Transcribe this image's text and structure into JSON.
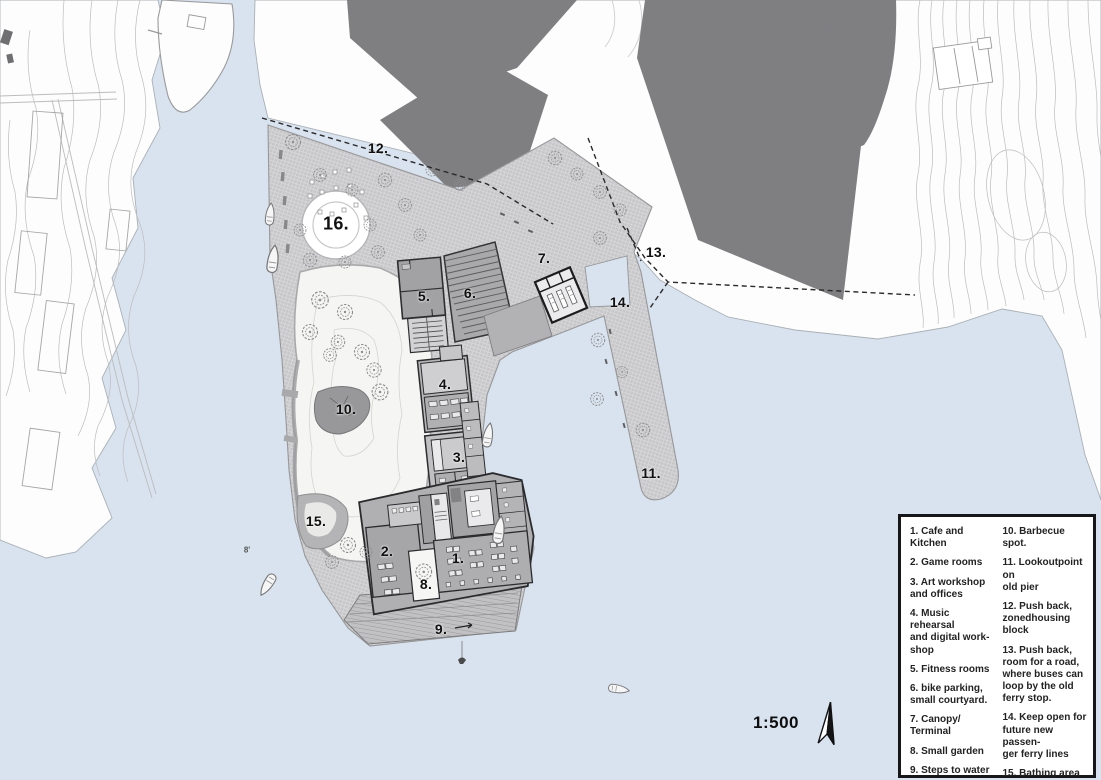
{
  "map": {
    "scale_label": "1:500",
    "labels": [
      {
        "n": "1.",
        "x": 458,
        "y": 558
      },
      {
        "n": "2.",
        "x": 387,
        "y": 551
      },
      {
        "n": "3.",
        "x": 459,
        "y": 457
      },
      {
        "n": "4.",
        "x": 445,
        "y": 384
      },
      {
        "n": "5.",
        "x": 424,
        "y": 296
      },
      {
        "n": "6.",
        "x": 470,
        "y": 293
      },
      {
        "n": "7.",
        "x": 544,
        "y": 258
      },
      {
        "n": "8.",
        "x": 426,
        "y": 584
      },
      {
        "n": "9.",
        "x": 441,
        "y": 629
      },
      {
        "n": "10.",
        "x": 346,
        "y": 409
      },
      {
        "n": "11.",
        "x": 651,
        "y": 473
      },
      {
        "n": "12.",
        "x": 378,
        "y": 148
      },
      {
        "n": "13.",
        "x": 656,
        "y": 252
      },
      {
        "n": "14.",
        "x": 620,
        "y": 302
      },
      {
        "n": "15.",
        "x": 316,
        "y": 521
      },
      {
        "n": "16.",
        "x": 336,
        "y": 224,
        "size": 18
      }
    ],
    "annotations": [
      {
        "text": "8'",
        "x": 247,
        "y": 550
      }
    ],
    "colors": {
      "water": "#d8e3ef",
      "land": "#fdfdfd",
      "blocks": "#7f7f82",
      "plaza_base": "#c7c7c9",
      "park": "#f5f5f3"
    }
  },
  "legend": {
    "left_items": [
      "1. Cafe and Kitchen",
      "2. Game rooms",
      "3. Art workshop\nand offices",
      "4. Music rehearsal\nand digital work-\nshop",
      "5. Fitness rooms",
      "6. bike parking,\nsmall courtyard.",
      "7. Canopy/ Terminal",
      "8.  Small garden",
      "9. Steps to water"
    ],
    "right_items": [
      "10. Barbecue spot.",
      "11. Lookoutpoint on\nold pier",
      "12.  Push back,\nzonedhousing\nblock",
      "13.  Push back,\nroom for a road,\nwhere buses can\nloop by the old\nferry stop.",
      "14. Keep open for\nfuture new passen-\nger ferry lines",
      "15. Bathing area",
      "16. Restaurant/Bar"
    ]
  }
}
